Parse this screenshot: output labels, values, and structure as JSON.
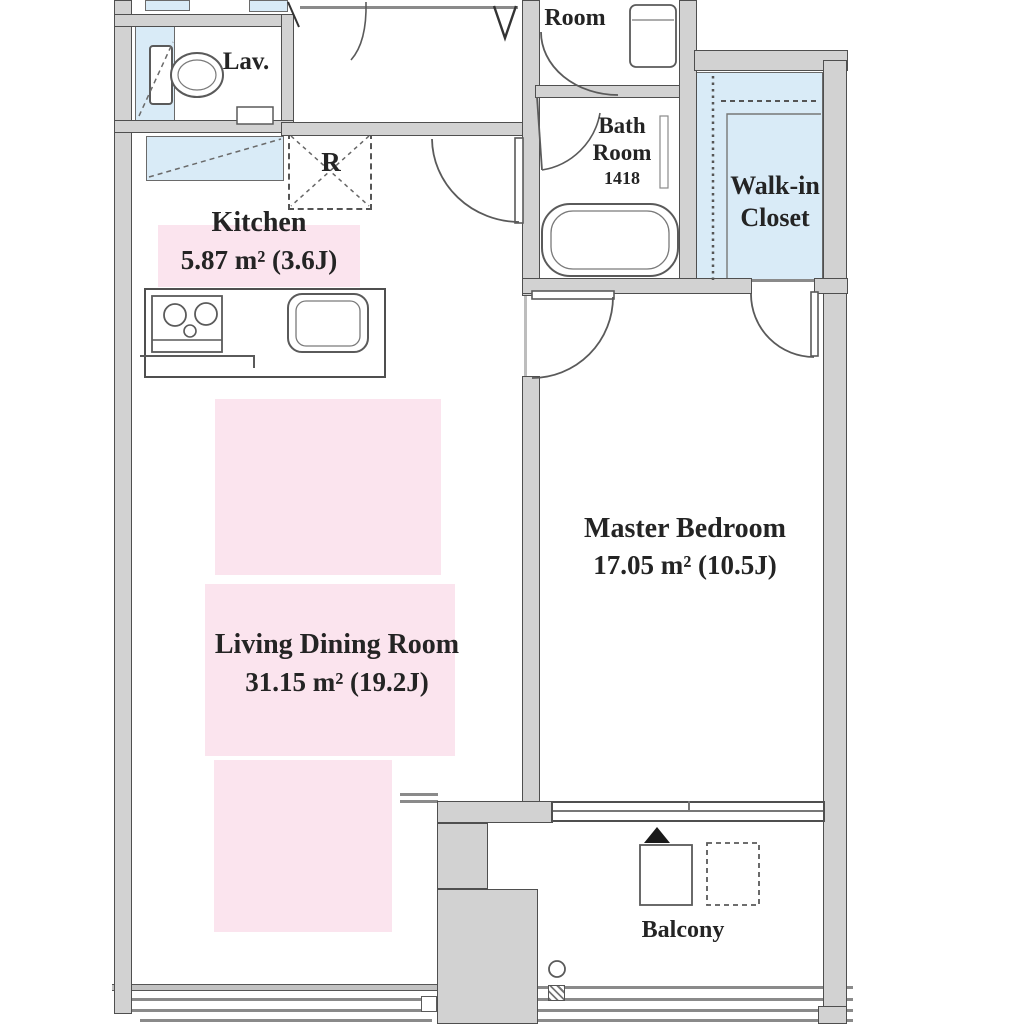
{
  "title": "Apartment floor plan",
  "rooms": {
    "dressing_room": {
      "name_line1": "Dressing",
      "name_line2": "Room"
    },
    "lavatory": {
      "label": "Lav."
    },
    "kitchen": {
      "name": "Kitchen",
      "area": "5.87 m²  (3.6J)"
    },
    "bath_room": {
      "name_line1": "Bath",
      "name_line2": "Room",
      "size_code": "1418"
    },
    "walk_in_closet": {
      "name_line1": "Walk-in",
      "name_line2": "Closet"
    },
    "master_bedroom": {
      "name": "Master Bedroom",
      "area": "17.05 m²  (10.5J)"
    },
    "living_dining_room": {
      "name": "Living Dining Room",
      "area": "31.15 m²  (19.2J)"
    },
    "balcony": {
      "label": "Balcony"
    },
    "refrigerator_space": {
      "label": "R"
    }
  },
  "colors": {
    "highlight_pink": "#fbe4ee",
    "fixture_blue": "#d9ebf7",
    "wall_fill": "#d2d2d2",
    "wall_edge": "#4f4f4f",
    "text": "#242424"
  }
}
